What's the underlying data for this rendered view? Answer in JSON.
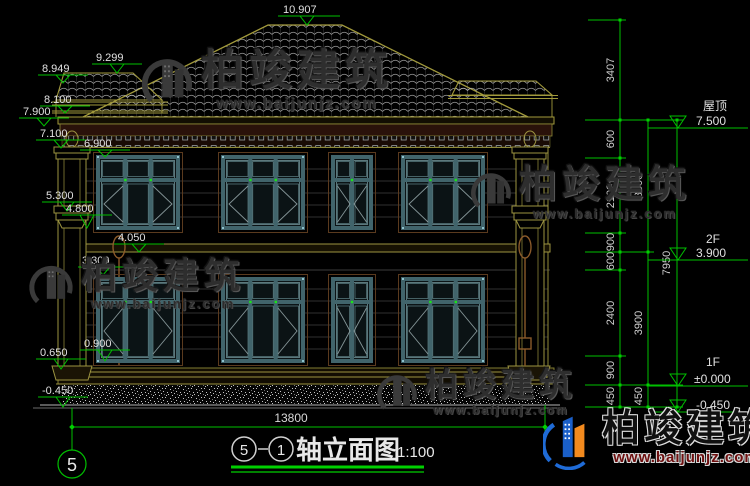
{
  "drawing_title": {
    "bubble_left": "5",
    "bubble_right": "1",
    "name": "轴立面图",
    "scale": "1:100"
  },
  "axis_bubble": "5",
  "left_marks": [
    "10.907",
    "9.299",
    "8.949",
    "8.100",
    "7.900",
    "7.100",
    "6.900",
    "5.300",
    "4.800",
    "4.050",
    "3.300",
    "0.900",
    "0.650",
    "-0.450"
  ],
  "right_col1": [
    "3407",
    "600",
    "2100",
    "900",
    "600",
    "2400",
    "900",
    "450"
  ],
  "right_col2": [
    "3600",
    "3900",
    "450"
  ],
  "right_col3": [
    "7950"
  ],
  "levels": {
    "roof_label": "屋顶",
    "roof_value": "7.500",
    "f2_label": "2F",
    "f2_value": "3.900",
    "f1_label": "1F",
    "f1_value": "±0.000",
    "ground_value": "-0.450"
  },
  "total_width_dim": "13800",
  "watermark": {
    "brand": "柏竣建筑",
    "url": "www.baijunjz.com"
  },
  "colors": {
    "background": "#000000",
    "cad_green": "#00bf00",
    "line_olive": "#9c9440",
    "window_teal": "#41646b",
    "dim_text": "#d9d9d9",
    "logo_blue": "#1f6bd6",
    "logo_orange": "#f28a1e",
    "logo_dark_red": "#6e0f0f"
  }
}
